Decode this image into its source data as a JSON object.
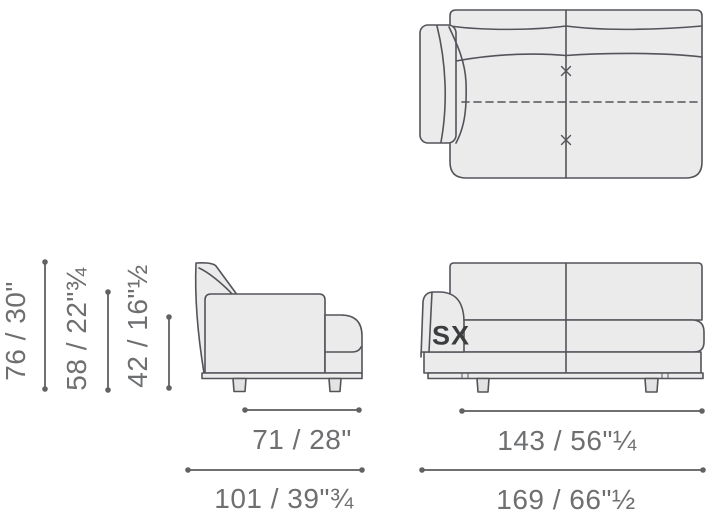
{
  "diagram": {
    "type": "furniture-dimension-drawing",
    "subject": "sofa-end-module"
  },
  "colors": {
    "background": "#ffffff",
    "sofa_fill": "#ebebeb",
    "sofa_outline": "#53545a",
    "leg_fill": "#e3e3e3",
    "dimension_line": "#6f7072",
    "dimension_text": "#6e6f71",
    "orientation_text": "#3c3d3f"
  },
  "views": {
    "top": {
      "name": "top view (plan)"
    },
    "side": {
      "name": "side view"
    },
    "front": {
      "name": "front view",
      "orientation_label": "SX"
    }
  },
  "dimensions": {
    "vertical": [
      {
        "id": "overall-height",
        "label": "76 / 30\""
      },
      {
        "id": "back-height",
        "label": "58 / 22\"¾"
      },
      {
        "id": "seat-height",
        "label": "42 / 16\"½"
      }
    ],
    "side_horizontal": [
      {
        "id": "seat-depth",
        "label": "71 / 28\""
      },
      {
        "id": "overall-depth",
        "label": "101 / 39\"¾"
      }
    ],
    "front_horizontal": [
      {
        "id": "seat-width",
        "label": "143 / 56\"¼"
      },
      {
        "id": "overall-width",
        "label": "169 / 66\"½"
      }
    ]
  }
}
